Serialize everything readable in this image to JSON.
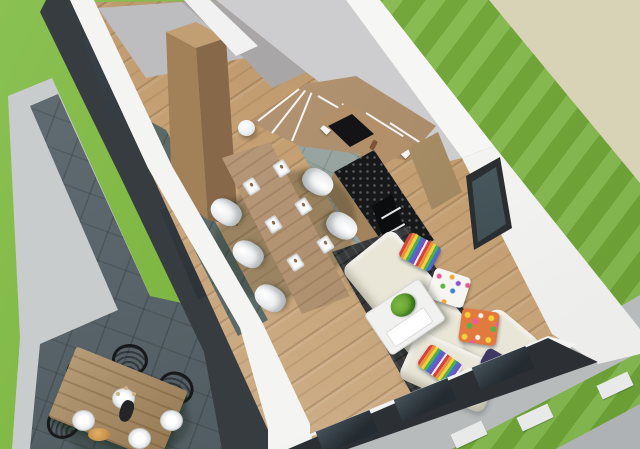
{
  "scene": {
    "type": "3d-architectural-interior-render",
    "view": "aerial-cutaway",
    "rooms": [
      "upper-storage-room",
      "entry-hall",
      "kitchen",
      "dining-area",
      "living-area",
      "terrace",
      "garden"
    ],
    "objects": [
      "lawn",
      "dirt-ground",
      "paved-path",
      "stepping-stones",
      "concrete-border",
      "slate-terrace",
      "outdoor-dining-table",
      "outdoor-wire-chairs",
      "outdoor-plates",
      "flower-vase",
      "fruit-bowl",
      "house-shell",
      "dark-facade-wall",
      "white-cut-walls",
      "winder-staircase",
      "stair-stringer",
      "wardrobe-cabinet",
      "floor-lamp-sphere",
      "kitchen-counter",
      "cooktop",
      "pepper-mill",
      "kitchen-island",
      "built-in-oven",
      "tall-cabinet",
      "dining-table",
      "dining-chairs-white",
      "place-settings",
      "area-rug",
      "corner-sofa",
      "throw-pillows",
      "coffee-table",
      "potted-plant",
      "side-window",
      "front-glazing"
    ],
    "counts": {
      "dining_chairs": 6,
      "place_settings": 6,
      "outdoor_chairs": 4,
      "outdoor_plates": 4,
      "throw_pillows": 5,
      "stepping_stones": 3
    }
  },
  "palette": {
    "grass": "#7cb43f",
    "grass_light": "#8ac153",
    "ground_beige": "#d8d2b6",
    "path": "#b7bbbc",
    "stone": "#e8eaea",
    "concrete_border": "#c9cccd",
    "slate": "#57646a",
    "wall_white": "#f4f4f3",
    "wall_gray_face": "#cdccce",
    "wall_dark": "#373c41",
    "wood": "#b3906a",
    "wood_floor": "#c49f72",
    "tile_kitchen": "#97a49f",
    "tile_entry": "#5c6a67",
    "rug": "#37393b",
    "sofa": "#e9e6d8",
    "counter_black": "#17181a",
    "plate_white": "#fafafa",
    "plant_green": "#7cb842"
  }
}
